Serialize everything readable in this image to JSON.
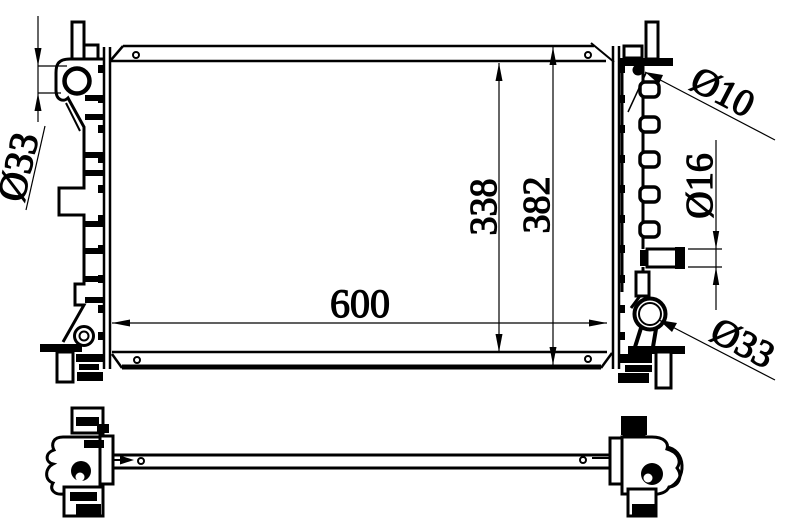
{
  "drawing": {
    "background": "#ffffff",
    "line_color": "#000000",
    "dimensions": {
      "left_port_diameter": "Ø33",
      "bleed_hole_diameter": "Ø10",
      "outlet_pipe_diameter": "Ø16",
      "right_port_diameter": "Ø33",
      "core_width": "600",
      "core_height": "338",
      "overall_height": "382"
    }
  }
}
